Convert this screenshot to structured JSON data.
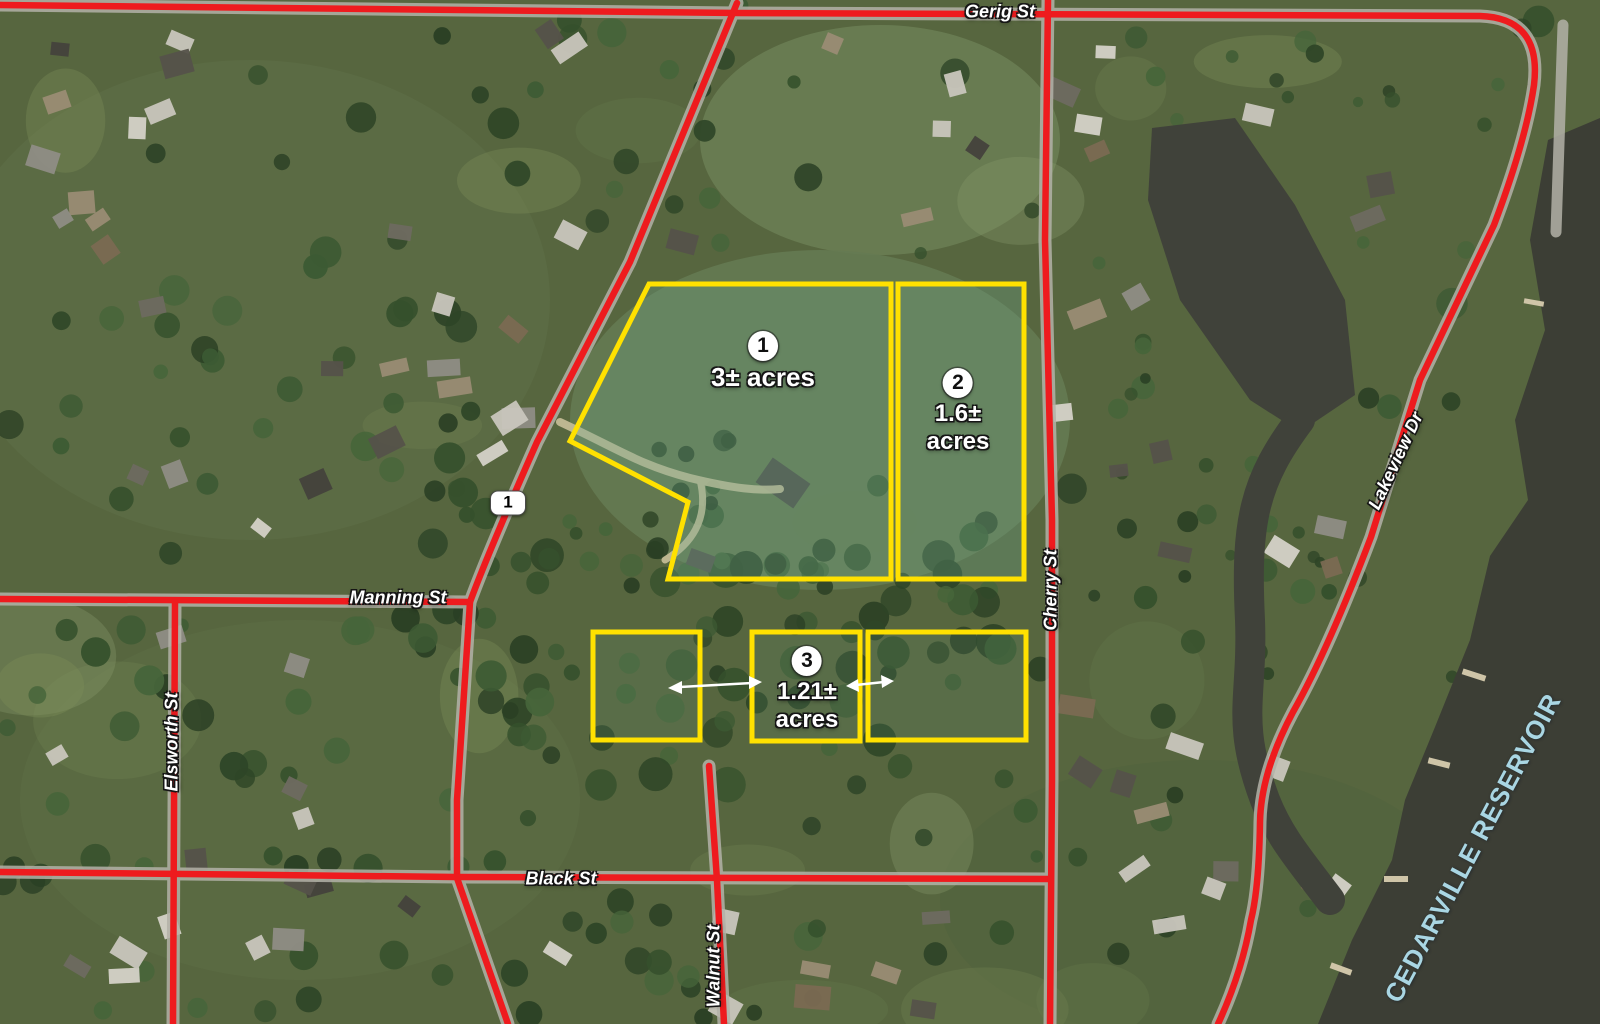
{
  "map": {
    "streets": {
      "gerig": {
        "label": "Gerig St"
      },
      "manning": {
        "label": "Manning St"
      },
      "elsworth": {
        "label": "Elsworth St"
      },
      "black": {
        "label": "Black St"
      },
      "walnut": {
        "label": "Walnut St"
      },
      "cherry": {
        "label": "Cherry St"
      },
      "lakeview": {
        "label": "Lakeview Dr"
      }
    },
    "route_marker": "1",
    "water_label": "CEDARVILLE RESERVOIR",
    "parcels": [
      {
        "badge": "1",
        "acreage_line1": "3± acres",
        "acreage_line2": ""
      },
      {
        "badge": "2",
        "acreage_line1": "1.6±",
        "acreage_line2": "acres"
      },
      {
        "badge": "3",
        "acreage_line1": "1.21±",
        "acreage_line2": "acres"
      }
    ],
    "colors": {
      "road_overlay": "#ee1b1e",
      "parcel_outline": "#ffe100",
      "water": "#3c3e35",
      "water_label_color": "#a9d6e3",
      "street_label_color": "#ffffff"
    }
  }
}
